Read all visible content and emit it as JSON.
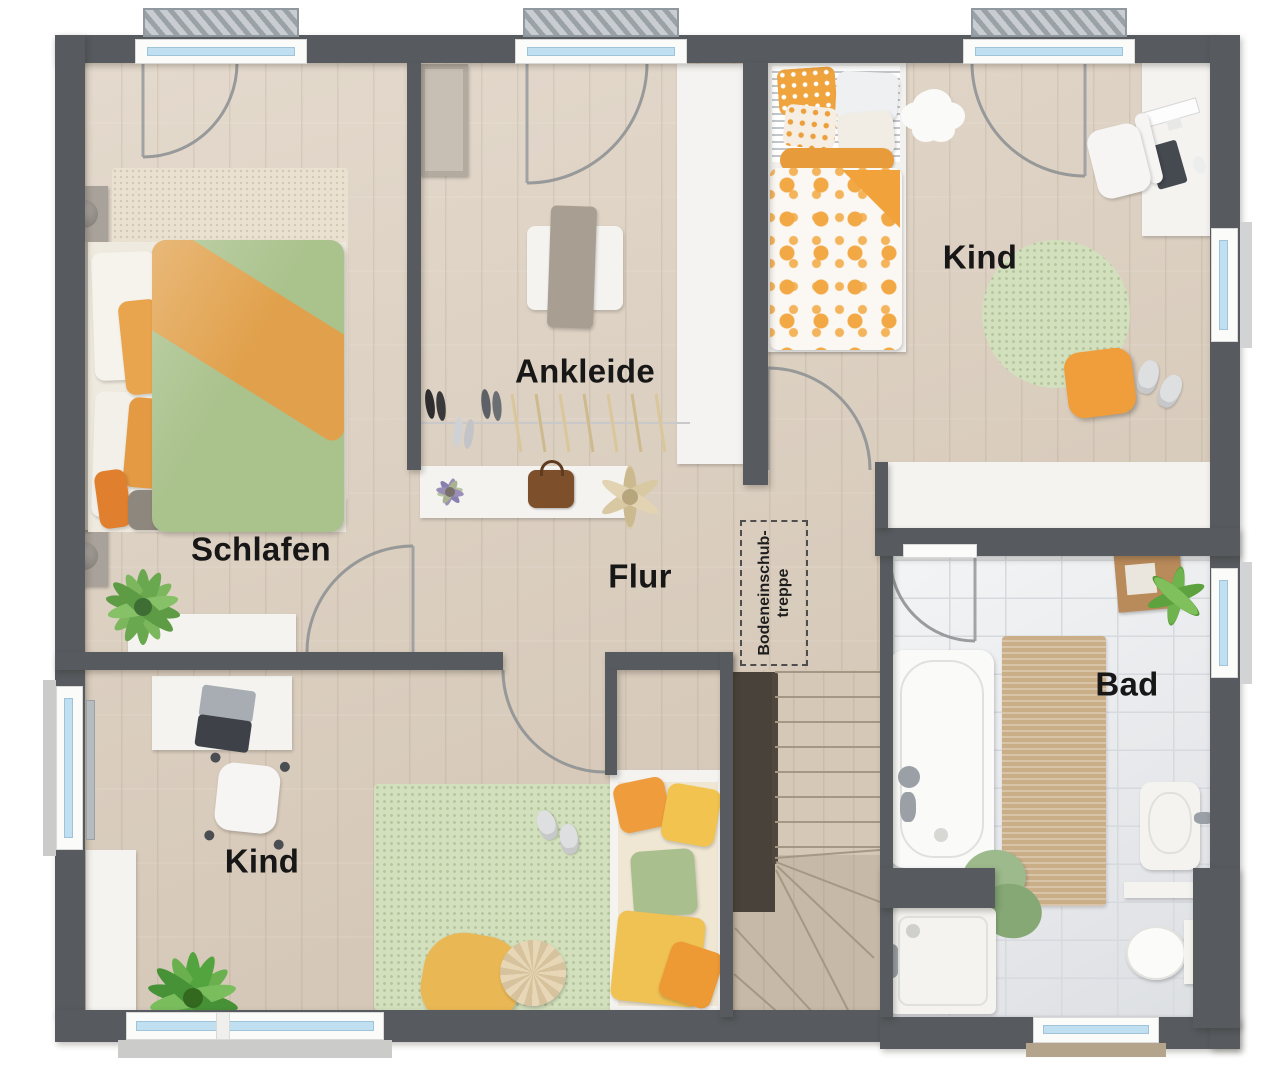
{
  "plan": {
    "rooms": [
      {
        "id": "schlafen",
        "label": "Schlafen"
      },
      {
        "id": "ankleide",
        "label": "Ankleide"
      },
      {
        "id": "kind_top",
        "label": "Kind"
      },
      {
        "id": "flur",
        "label": "Flur"
      },
      {
        "id": "kind_bottom",
        "label": "Kind"
      },
      {
        "id": "bad",
        "label": "Bad"
      }
    ],
    "attic_hatch": {
      "line1": "Bodeneinschub-",
      "line2": "treppe"
    },
    "colors": {
      "wall": "#575b5f",
      "wood_floor": "#ddd0c0",
      "tile_floor": "#e7e9ec",
      "stair_wood": "#d5c8b6",
      "window_glass": "#c0dff0",
      "radiator": "#b9c0c5",
      "rug_cream": "#eae1d1",
      "rug_green": "#d3e0bd",
      "duvet_green": "#aac28c",
      "accent_orange": "#eda344",
      "bath_mat": "#c9ae88",
      "label_text": "#171717"
    }
  }
}
